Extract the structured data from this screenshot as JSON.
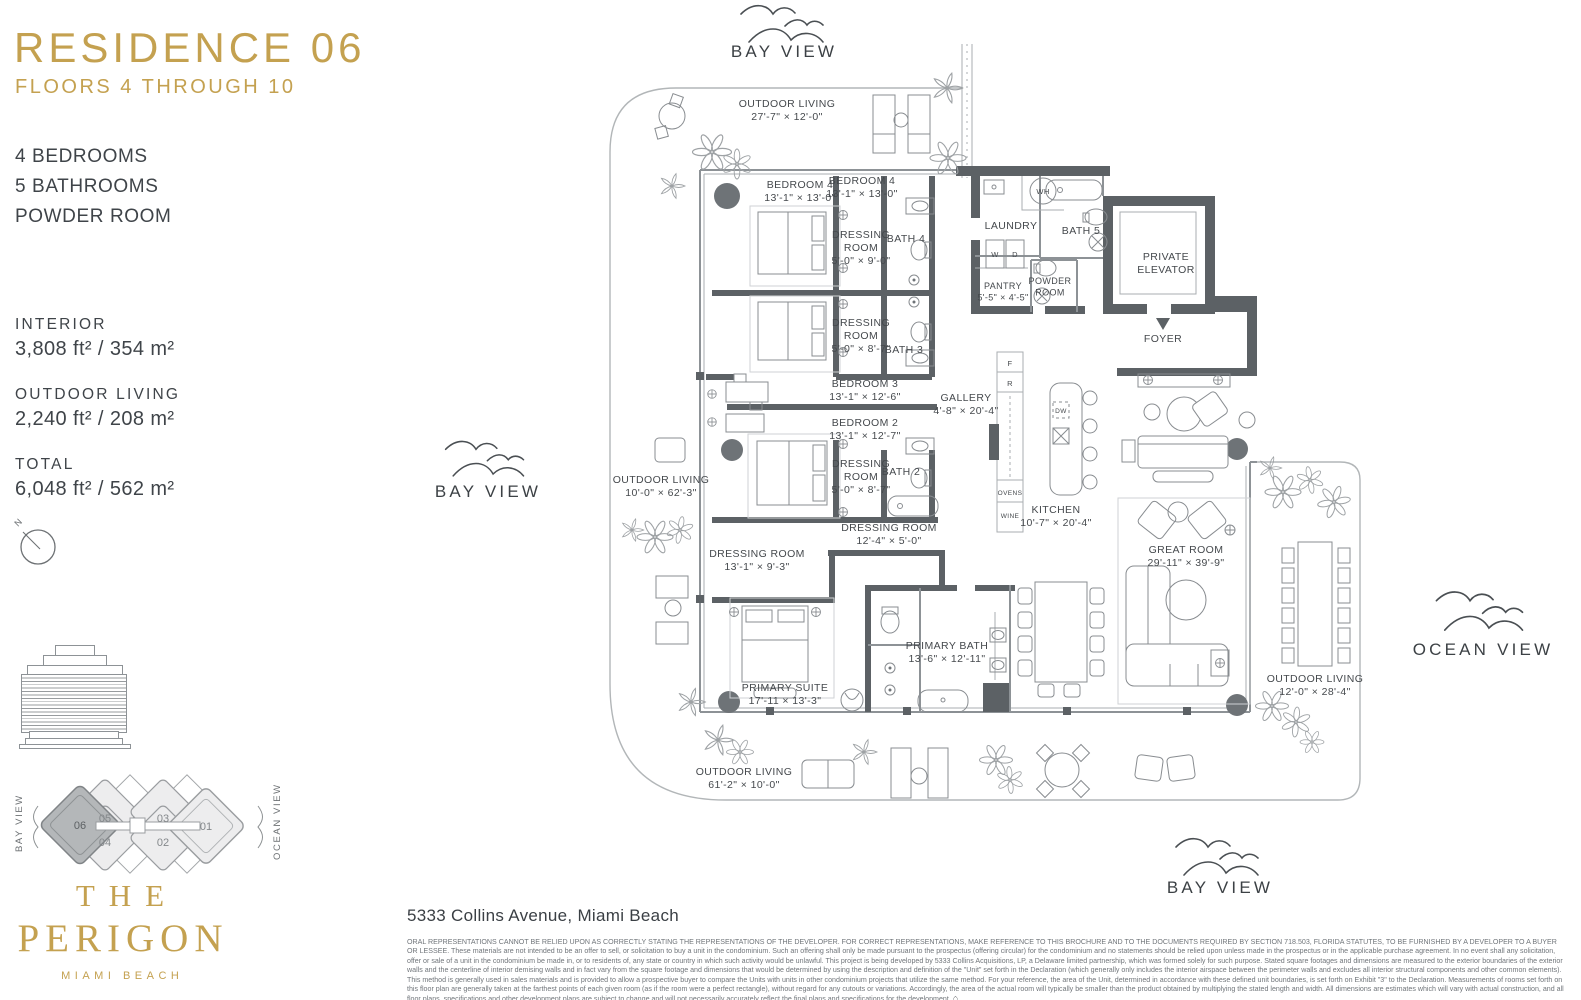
{
  "sidebar": {
    "title": "RESIDENCE 06",
    "subtitle": "FLOORS 4 THROUGH 10",
    "features": [
      "4 BEDROOMS",
      "5 BATHROOMS",
      "POWDER ROOM"
    ],
    "stats": [
      {
        "label": "INTERIOR",
        "value": "3,808 ft² / 354 m²"
      },
      {
        "label": "OUTDOOR LIVING",
        "value": "2,240 ft² / 208 m²"
      },
      {
        "label": "TOTAL",
        "value": "6,048 ft² / 562 m²"
      }
    ],
    "compass_label": "N",
    "keyplan": {
      "left_label": "BAY VIEW",
      "right_label": "OCEAN VIEW",
      "units": [
        "06",
        "05",
        "04",
        "03",
        "02",
        "01"
      ],
      "highlighted_unit": "06",
      "highlight_color": "#b4b7b9"
    },
    "logo": {
      "line1": "THE",
      "line2": "PERIGON",
      "tagline": "MIAMI BEACH"
    },
    "accent_color": "#c4a150"
  },
  "plan": {
    "views": {
      "top": "BAY VIEW",
      "left": "BAY VIEW",
      "bottom": "BAY VIEW",
      "right": "OCEAN VIEW"
    },
    "labels": [
      {
        "id": "outdoor-living-top",
        "x": 787,
        "y": 107,
        "lines": [
          "OUTDOOR LIVING",
          "27'-7\" × 12'-0\""
        ]
      },
      {
        "id": "bedroom-4a",
        "x": 800,
        "y": 188,
        "lines": [
          "BEDROOM 4",
          "13'-1\" × 13'-0\""
        ]
      },
      {
        "id": "bedroom-4b",
        "x": 862,
        "y": 184,
        "lines": [
          "BEDROOM 4",
          "13'-1\" × 13'-0\""
        ]
      },
      {
        "id": "dressing-room-4",
        "x": 861,
        "y": 238,
        "lines": [
          "DRESSING",
          "ROOM",
          "5'-0\" × 9'-0\""
        ]
      },
      {
        "id": "bath-4",
        "x": 906,
        "y": 242,
        "lines": [
          "BATH 4"
        ]
      },
      {
        "id": "dressing-room-3",
        "x": 861,
        "y": 326,
        "lines": [
          "DRESSING",
          "ROOM",
          "5'-0\" × 8'-7\""
        ]
      },
      {
        "id": "bath-3",
        "x": 904,
        "y": 353,
        "lines": [
          "BATH 3"
        ]
      },
      {
        "id": "bedroom-3",
        "x": 865,
        "y": 387,
        "lines": [
          "BEDROOM 3",
          "13'-1\" × 12'-6\""
        ]
      },
      {
        "id": "bedroom-2",
        "x": 865,
        "y": 426,
        "lines": [
          "BEDROOM 2",
          "13'-1\" × 12'-7\""
        ]
      },
      {
        "id": "dressing-room-2",
        "x": 861,
        "y": 467,
        "lines": [
          "DRESSING",
          "ROOM",
          "5'-0\" × 8'-7\""
        ]
      },
      {
        "id": "bath-2",
        "x": 901,
        "y": 475,
        "lines": [
          "BATH 2"
        ]
      },
      {
        "id": "gallery",
        "x": 966,
        "y": 401,
        "lines": [
          "GALLERY",
          "4'-8\" × 20'-4\""
        ]
      },
      {
        "id": "dressing-room-mid",
        "x": 889,
        "y": 531,
        "lines": [
          "DRESSING ROOM",
          "12'-4\" × 5'-0\""
        ]
      },
      {
        "id": "dressing-room-primary",
        "x": 757,
        "y": 557,
        "lines": [
          "DRESSING ROOM",
          "13'-1\" × 9'-3\""
        ]
      },
      {
        "id": "primary-suite",
        "x": 785,
        "y": 691,
        "lines": [
          "PRIMARY SUITE",
          "17'-11 × 13'-3\""
        ]
      },
      {
        "id": "primary-bath",
        "x": 947,
        "y": 649,
        "lines": [
          "PRIMARY BATH",
          "13'-6\" × 12'-11\""
        ]
      },
      {
        "id": "kitchen",
        "x": 1056,
        "y": 513,
        "lines": [
          "KITCHEN",
          "10'-7\" × 20'-4\""
        ]
      },
      {
        "id": "great-room",
        "x": 1186,
        "y": 553,
        "lines": [
          "GREAT ROOM",
          "29'-11\" × 39'-9\""
        ]
      },
      {
        "id": "outdoor-living-left",
        "x": 661,
        "y": 483,
        "lines": [
          "OUTDOOR LIVING",
          "10'-0\" × 62'-3\""
        ]
      },
      {
        "id": "outdoor-living-bottom",
        "x": 744,
        "y": 775,
        "lines": [
          "OUTDOOR LIVING",
          "61'-2\" × 10'-0\""
        ]
      },
      {
        "id": "outdoor-living-right",
        "x": 1315,
        "y": 682,
        "lines": [
          "OUTDOOR LIVING",
          "12'-0\" × 28'-4\""
        ]
      },
      {
        "id": "laundry",
        "x": 1011,
        "y": 229,
        "lines": [
          "LAUNDRY"
        ]
      },
      {
        "id": "bath-5",
        "x": 1081,
        "y": 234,
        "lines": [
          "BATH 5"
        ]
      },
      {
        "id": "pantry",
        "x": 1003,
        "y": 289,
        "fs": 9,
        "lines": [
          "PANTRY",
          "5'-5\" × 4'-5\""
        ]
      },
      {
        "id": "powder-room",
        "x": 1050,
        "y": 284,
        "fs": 9,
        "lines": [
          "POWDER",
          "ROOM"
        ]
      },
      {
        "id": "private-elevator",
        "x": 1166,
        "y": 260,
        "lines": [
          "PRIVATE",
          "ELEVATOR"
        ]
      },
      {
        "id": "foyer",
        "x": 1163,
        "y": 342,
        "lines": [
          "FOYER"
        ]
      },
      {
        "id": "wh",
        "x": 1043,
        "y": 194,
        "fs": 7.5,
        "lines": [
          "WH"
        ]
      },
      {
        "id": "washer",
        "x": 995,
        "y": 257,
        "fs": 7.5,
        "lines": [
          "W"
        ]
      },
      {
        "id": "dryer",
        "x": 1015,
        "y": 257,
        "fs": 7.5,
        "lines": [
          "D"
        ]
      },
      {
        "id": "fridge-freezer",
        "x": 1010,
        "y": 366,
        "fs": 7.5,
        "lines": [
          "F"
        ]
      },
      {
        "id": "fridge",
        "x": 1010,
        "y": 386,
        "fs": 7.5,
        "lines": [
          "R"
        ]
      },
      {
        "id": "ovens",
        "x": 1010,
        "y": 495,
        "fs": 6.5,
        "lines": [
          "OVENS"
        ]
      },
      {
        "id": "wine",
        "x": 1010,
        "y": 518,
        "fs": 6.5,
        "lines": [
          "WINE"
        ]
      },
      {
        "id": "dw",
        "x": 1061,
        "y": 413,
        "fs": 6.5,
        "lines": [
          "DW"
        ]
      }
    ]
  },
  "footer": {
    "address": "5333 Collins Avenue, Miami Beach",
    "disclaimer": "ORAL REPRESENTATIONS CANNOT BE RELIED UPON AS CORRECTLY STATING THE REPRESENTATIONS OF THE DEVELOPER. FOR CORRECT REPRESENTATIONS, MAKE REFERENCE TO THIS BROCHURE AND TO THE DOCUMENTS REQUIRED BY SECTION 718.503, FLORIDA STATUTES, TO BE FURNISHED BY A DEVELOPER TO A BUYER OR LESSEE. These materials are not intended to be an offer to sell, or solicitation to buy a unit in the condominium. Such an offering shall only be made pursuant to the prospectus (offering circular) for the condominium and no statements should be relied upon unless made in the prospectus or in the applicable purchase agreement. In no event shall any solicitation, offer or sale of a unit in the condominium be made in, or to residents of, any state or country in which such activity would be unlawful. This project is being developed by 5333 Collins Acquisitions, LP, a Delaware limited partnership, which was formed solely for such purpose. Stated square footages and dimensions are measured to the exterior boundaries of the exterior walls and the centerline of interior demising walls and in fact vary from the square footage and dimensions that would be determined by using the description and definition of the \"Unit\" set forth in the Declaration (which generally only includes the interior airspace between the perimeter walls and excludes all interior structural components and other common elements). This method is generally used in sales materials and is provided to allow a prospective buyer to compare the Units with units in other condominium projects that utilize the same method. For your reference, the area of the Unit, determined in accordance with these defined unit boundaries, is set forth on Exhibit \"3\" to the Declaration. Measurements of rooms set forth on this floor plan are generally taken at the farthest points of each given room (as if the room were a perfect rectangle), without regard for any cutouts or variations. Accordingly, the area of the actual room will typically be smaller than the product obtained by multiplying the stated length and width. All dimensions are estimates which will vary with actual construction, and all floor plans, specifications and other development plans are subject to change and will not necessarily accurately reflect the final plans and specifications for the development."
  }
}
